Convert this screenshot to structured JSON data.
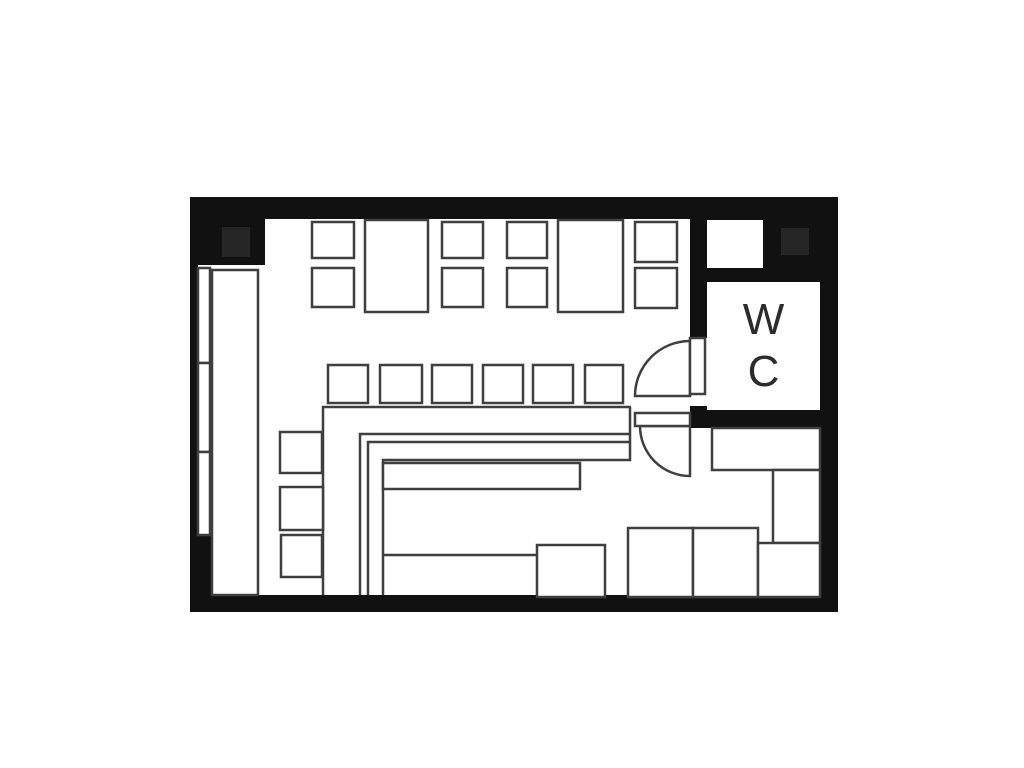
{
  "title": "restaurant-floor-plan",
  "wc_label": {
    "line1": "W",
    "line2": "C"
  },
  "colors": {
    "background": "#ffffff",
    "wall": "#111111",
    "column": "#262626",
    "floor": "#ffffff",
    "outline": "#3f3f3f"
  },
  "walls": [
    {
      "name": "wall-top-band",
      "rect": [
        190,
        197,
        648,
        22
      ]
    },
    {
      "name": "wall-corner-top-left",
      "rect": [
        190,
        197,
        75,
        68
      ]
    },
    {
      "name": "wall-left",
      "rect": [
        190,
        197,
        8,
        415
      ]
    },
    {
      "name": "wall-corner-bottom-left",
      "rect": [
        190,
        535,
        22,
        77
      ]
    },
    {
      "name": "wall-bottom-band",
      "rect": [
        190,
        595,
        648,
        17
      ]
    },
    {
      "name": "wall-right",
      "rect": [
        820,
        197,
        18,
        415
      ]
    },
    {
      "name": "wall-corner-top-right",
      "rect": [
        690,
        197,
        148,
        85
      ]
    },
    {
      "name": "wall-wc-left",
      "rect": [
        690,
        282,
        17,
        56
      ]
    },
    {
      "name": "wall-door-pier",
      "rect": [
        690,
        406,
        17,
        22
      ]
    },
    {
      "name": "wall-wc-bottom",
      "rect": [
        690,
        410,
        148,
        18
      ]
    }
  ],
  "columns": [
    {
      "name": "column-top-left",
      "rect": [
        222,
        227,
        28,
        30
      ]
    },
    {
      "name": "column-top-right",
      "rect": [
        781,
        228,
        28,
        27
      ]
    }
  ],
  "openings": [
    {
      "name": "entrance-recess",
      "rect": [
        707,
        220,
        56,
        48
      ]
    },
    {
      "name": "wc-room-floor",
      "rect": [
        707,
        282,
        113,
        128
      ]
    }
  ],
  "lines": [
    {
      "name": "counter-outer-edge",
      "path": "M323,595 L323,407 L631,407"
    },
    {
      "name": "counter-inner-edge-1",
      "path": "M360,595 L360,434 L631,434"
    },
    {
      "name": "counter-inner-edge-2",
      "path": "M368,595 L368,442 L629,442"
    },
    {
      "name": "counter-right-return",
      "path": "M630,407 L630,460 L383,460 L383,595"
    },
    {
      "name": "kitchen-divider-line",
      "path": "M383,555 L537,555"
    }
  ],
  "furniture": [
    {
      "name": "window-panel-1",
      "rect": [
        198,
        268,
        12,
        95
      ]
    },
    {
      "name": "window-panel-2",
      "rect": [
        198,
        363,
        12,
        89
      ]
    },
    {
      "name": "window-panel-3",
      "rect": [
        198,
        452,
        12,
        83
      ]
    },
    {
      "name": "wall-bench",
      "rect": [
        212,
        270,
        46,
        325
      ]
    },
    {
      "name": "table-top-1",
      "rect": [
        365,
        220,
        63,
        92
      ]
    },
    {
      "name": "table-top-2",
      "rect": [
        558,
        220,
        65,
        92
      ]
    },
    {
      "name": "chair-top-1a",
      "rect": [
        312,
        222,
        42,
        36
      ]
    },
    {
      "name": "chair-top-1b",
      "rect": [
        312,
        268,
        42,
        39
      ]
    },
    {
      "name": "chair-top-2a",
      "rect": [
        442,
        222,
        41,
        36
      ]
    },
    {
      "name": "chair-top-2b",
      "rect": [
        442,
        268,
        41,
        39
      ]
    },
    {
      "name": "chair-top-3a",
      "rect": [
        507,
        222,
        40,
        36
      ]
    },
    {
      "name": "chair-top-3b",
      "rect": [
        507,
        268,
        40,
        39
      ]
    },
    {
      "name": "chair-top-4a",
      "rect": [
        635,
        222,
        42,
        40
      ]
    },
    {
      "name": "chair-top-4b",
      "rect": [
        635,
        268,
        42,
        40
      ]
    },
    {
      "name": "counter-stool-1",
      "rect": [
        328,
        365,
        40,
        38
      ]
    },
    {
      "name": "counter-stool-2",
      "rect": [
        380,
        365,
        42,
        38
      ]
    },
    {
      "name": "counter-stool-3",
      "rect": [
        432,
        365,
        40,
        38
      ]
    },
    {
      "name": "counter-stool-4",
      "rect": [
        483,
        365,
        40,
        38
      ]
    },
    {
      "name": "counter-stool-5",
      "rect": [
        533,
        365,
        40,
        38
      ]
    },
    {
      "name": "counter-stool-6",
      "rect": [
        585,
        365,
        38,
        38
      ]
    },
    {
      "name": "chair-left-1",
      "rect": [
        280,
        432,
        42,
        41
      ]
    },
    {
      "name": "chair-left-2",
      "rect": [
        280,
        487,
        43,
        43
      ]
    },
    {
      "name": "chair-left-3",
      "rect": [
        281,
        535,
        41,
        42
      ]
    },
    {
      "name": "kitchen-bar",
      "rect": [
        383,
        463,
        197,
        26
      ]
    },
    {
      "name": "kitchen-table",
      "rect": [
        537,
        545,
        68,
        52
      ]
    },
    {
      "name": "table-bottom-1",
      "rect": [
        628,
        528,
        65,
        69
      ]
    },
    {
      "name": "table-bottom-2",
      "rect": [
        693,
        528,
        65,
        69
      ]
    },
    {
      "name": "cabinet-right",
      "rect": [
        712,
        428,
        108,
        42
      ]
    },
    {
      "name": "storage-right",
      "rect": [
        773,
        470,
        47,
        73
      ]
    },
    {
      "name": "counter-bottom-right",
      "rect": [
        758,
        543,
        62,
        54
      ]
    }
  ],
  "door_swings": [
    {
      "name": "wc-door-swing",
      "path": "M690,396 L690,341 A55,55 0 0 0 635,396 Z"
    },
    {
      "name": "service-door-swing",
      "path": "M690,426 L640,426 A50,50 0 0 0 690,476 Z"
    }
  ],
  "door_leaves": [
    {
      "name": "wc-door-leaf",
      "rect": [
        690,
        338,
        15,
        56
      ]
    },
    {
      "name": "service-door-leaf",
      "rect": [
        635,
        413,
        55,
        13
      ]
    }
  ]
}
